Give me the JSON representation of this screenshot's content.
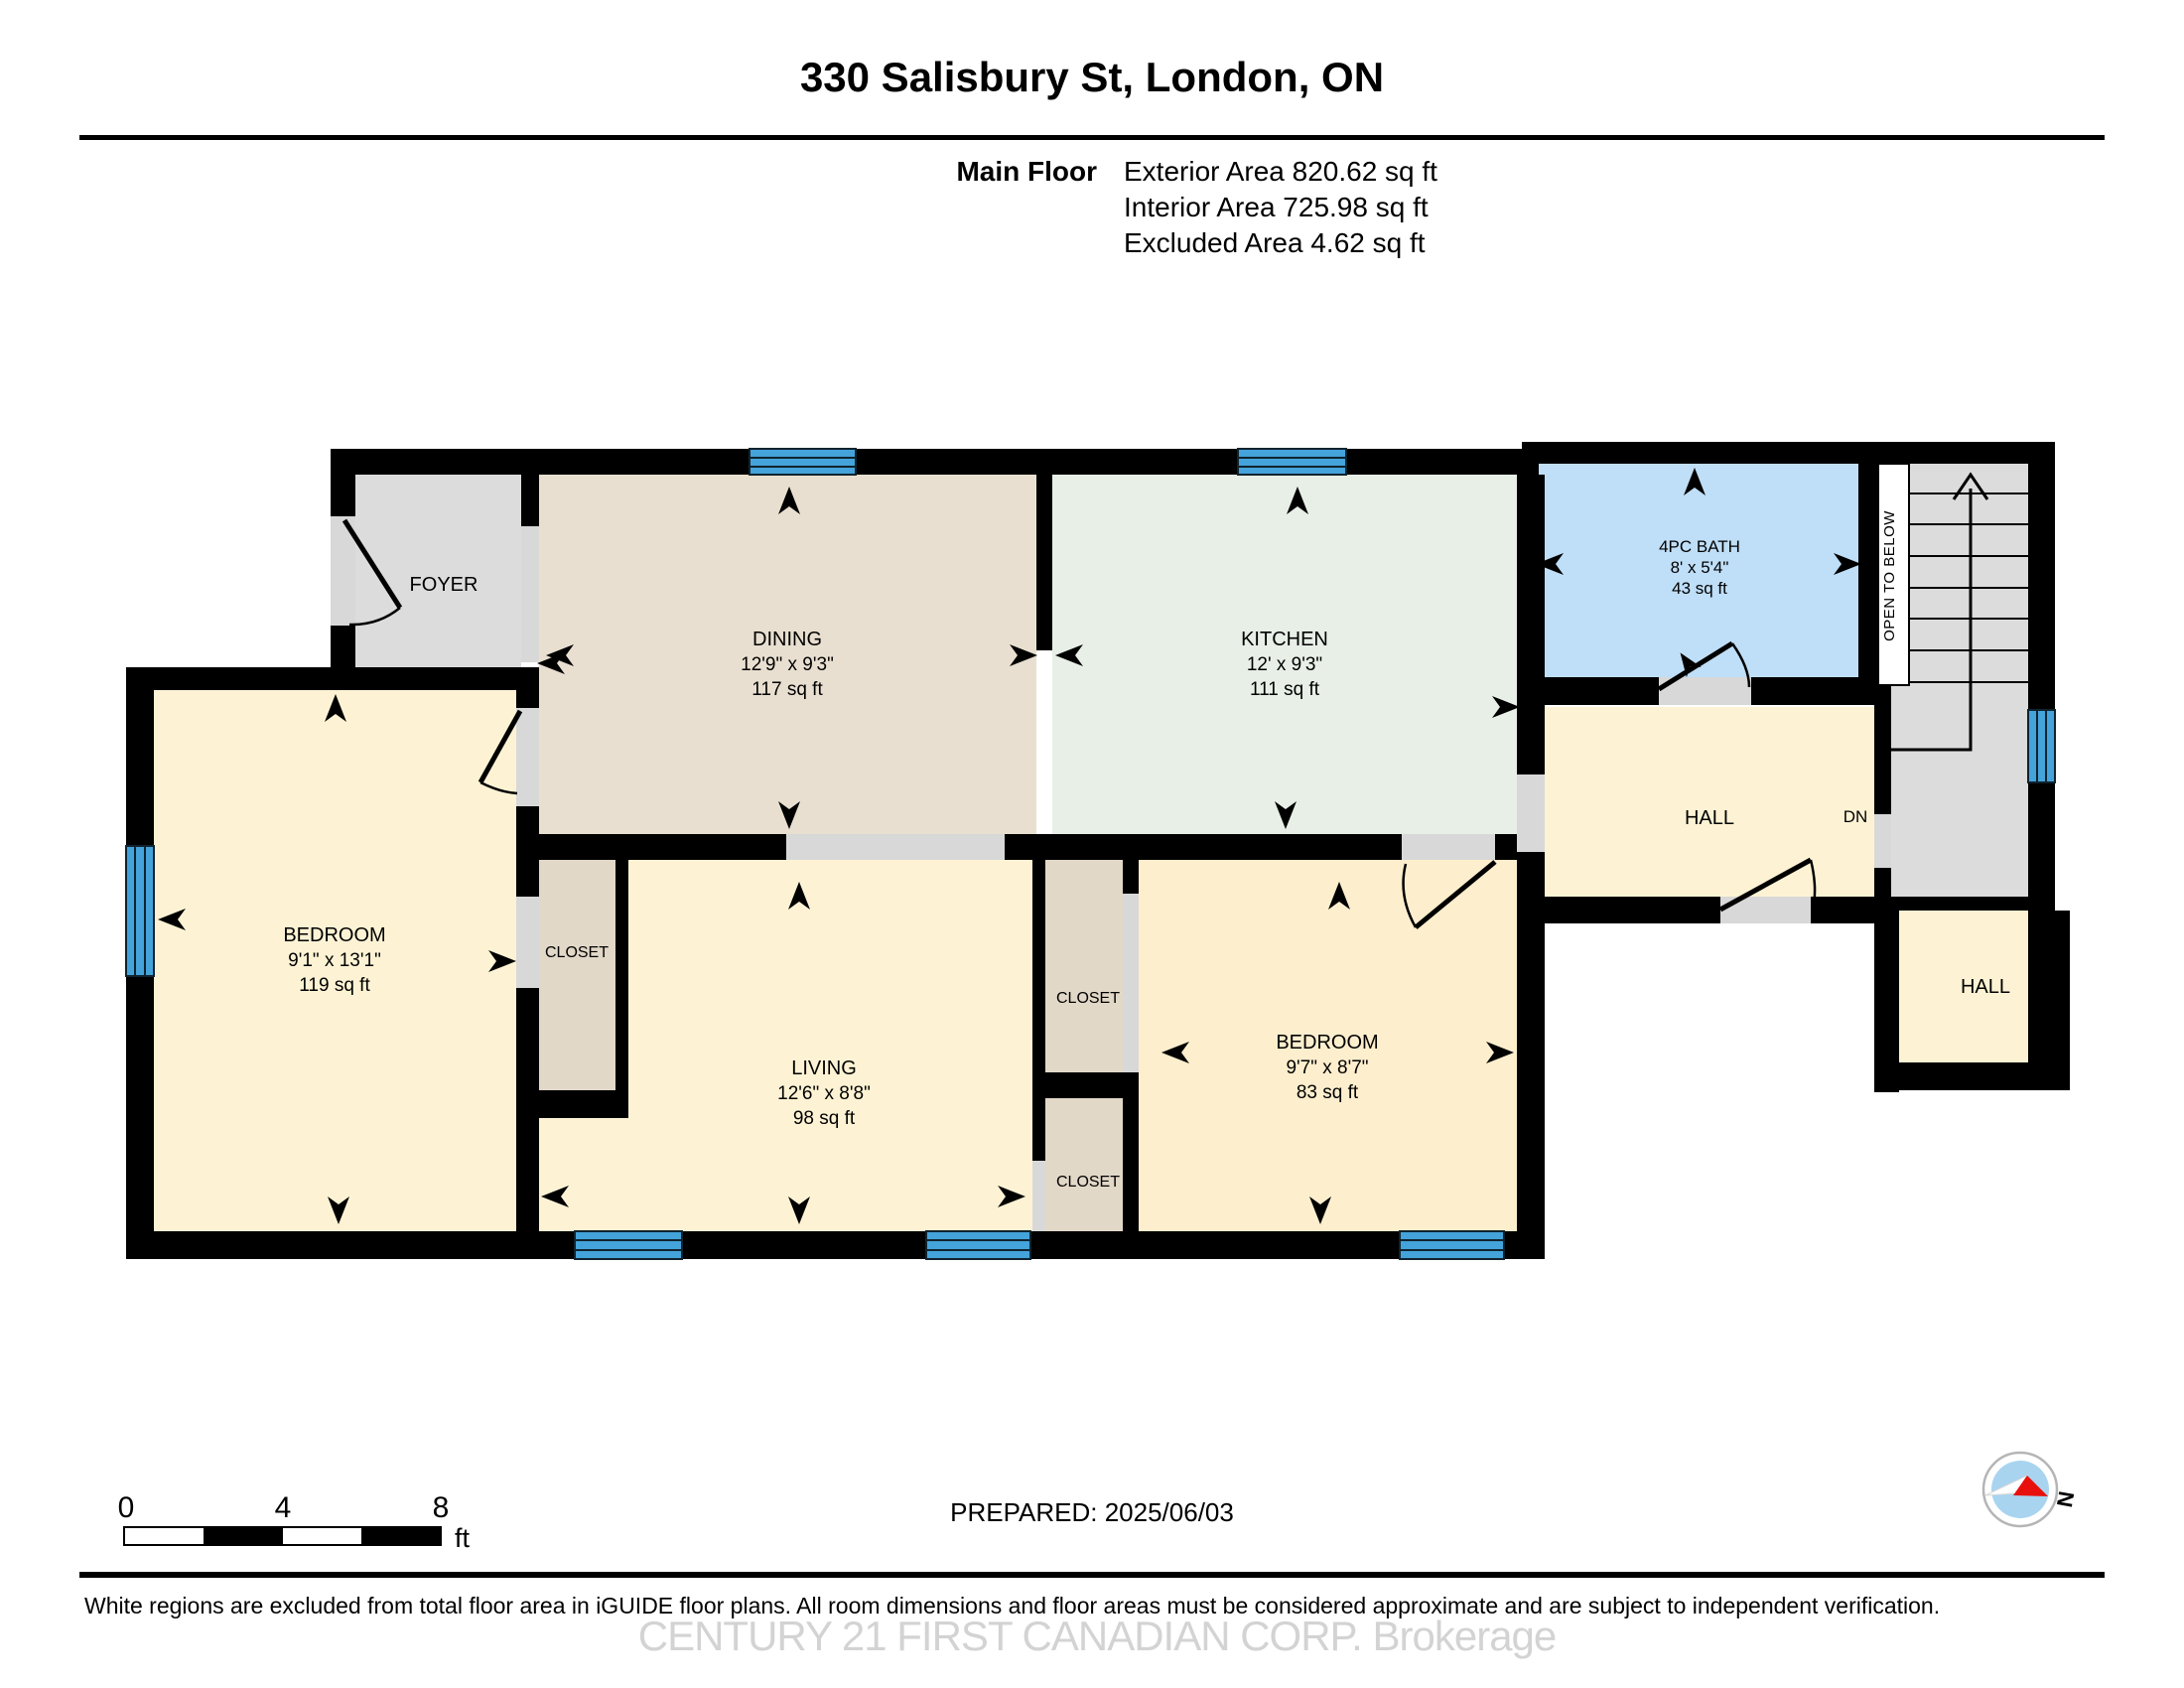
{
  "header": {
    "title": "330 Salisbury St, London, ON",
    "floor_label": "Main Floor",
    "exterior_area": "Exterior Area 820.62 sq ft",
    "interior_area": "Interior Area 725.98 sq ft",
    "excluded_area": "Excluded Area 4.62 sq ft"
  },
  "rooms": {
    "foyer": {
      "name": "FOYER"
    },
    "dining": {
      "name": "DINING",
      "dims": "12'9\" x 9'3\"",
      "area": "117 sq ft"
    },
    "kitchen": {
      "name": "KITCHEN",
      "dims": "12' x 9'3\"",
      "area": "111 sq ft"
    },
    "bath": {
      "name": "4PC BATH",
      "dims": "8' x 5'4\"",
      "area": "43 sq ft"
    },
    "bedroom_left": {
      "name": "BEDROOM",
      "dims": "9'1\" x 13'1\"",
      "area": "119 sq ft"
    },
    "living": {
      "name": "LIVING",
      "dims": "12'6\" x 8'8\"",
      "area": "98 sq ft"
    },
    "bedroom_right": {
      "name": "BEDROOM",
      "dims": "9'7\" x 8'7\"",
      "area": "83 sq ft"
    },
    "hall_upper": {
      "name": "HALL",
      "dn": "DN"
    },
    "hall_lower": {
      "name": "HALL"
    },
    "closet_left": {
      "name": "CLOSET"
    },
    "closet_mid_top": {
      "name": "CLOSET"
    },
    "closet_mid_bottom": {
      "name": "CLOSET"
    },
    "open_to_below": {
      "name": "OPEN TO BELOW"
    }
  },
  "footer": {
    "scale": {
      "tick0": "0",
      "tick4": "4",
      "tick8": "8",
      "unit": "ft"
    },
    "prepared": "PREPARED: 2025/06/03",
    "compass_north": "N",
    "disclaimer": "White regions are excluded from total floor area in iGUIDE floor plans. All room dimensions and floor areas must be considered approximate and are subject to independent verification.",
    "watermark": "CENTURY 21 FIRST CANADIAN CORP. Brokerage"
  }
}
